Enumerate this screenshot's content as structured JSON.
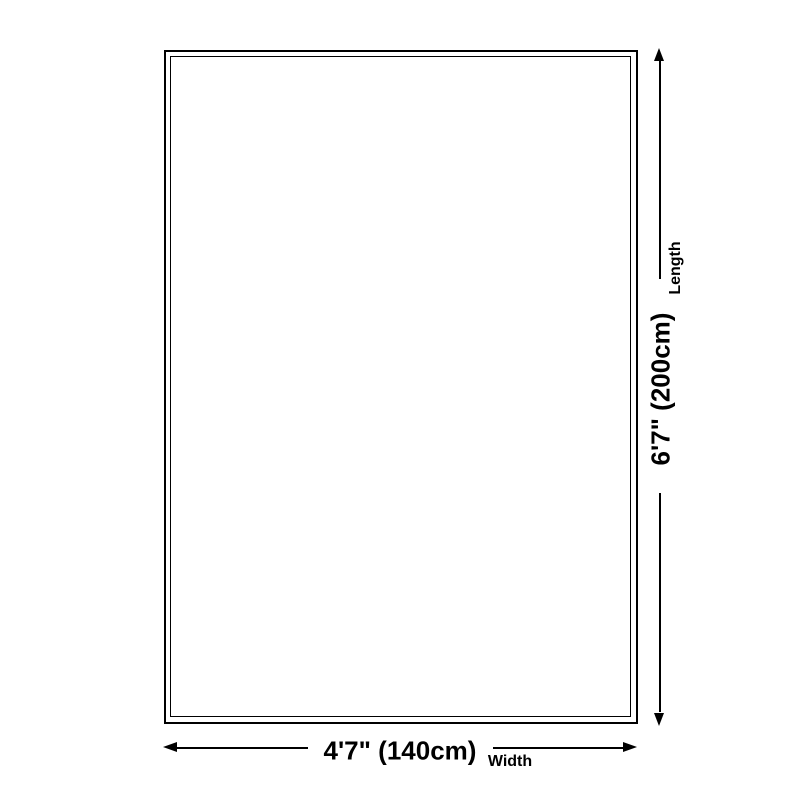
{
  "page": {
    "background_color": "#ffffff",
    "ink_color": "#000000"
  },
  "diagram": {
    "type": "product-size-diagram",
    "shape": "rectangle-double-outline",
    "length": {
      "value": "6'7\" (200cm)",
      "label": "Length"
    },
    "width": {
      "value": "4'7\" (140cm)",
      "label": "Width"
    }
  }
}
